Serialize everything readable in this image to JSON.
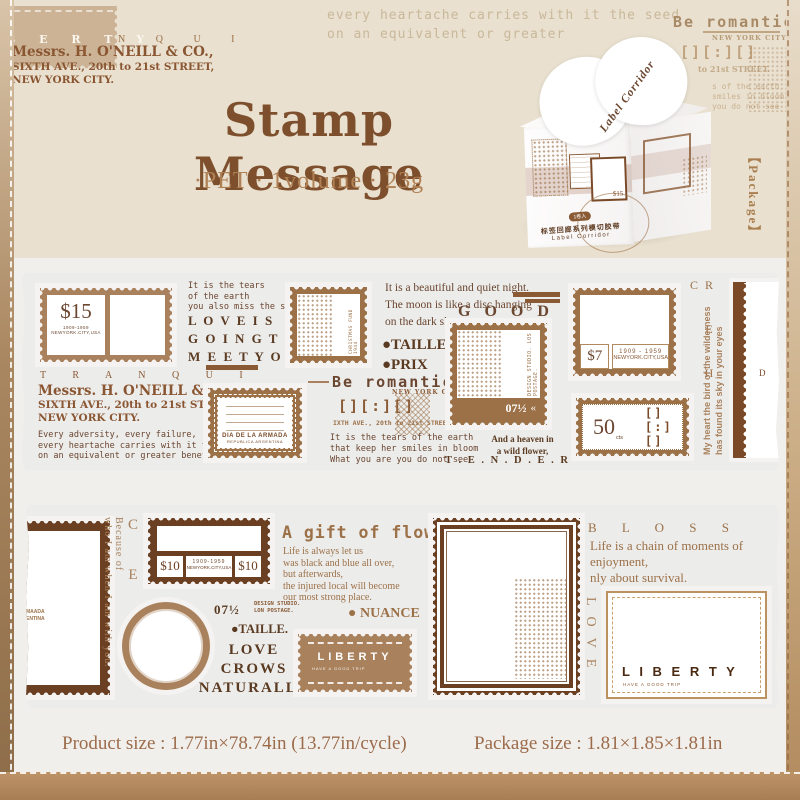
{
  "header": {
    "collage_white": "B E R T Y",
    "collage_brown": "N Q U I",
    "address1": "Messrs. H. O'NEILL & CO.,",
    "address2": "SIXTH AVE., 20th to 21st STREET,",
    "address3": "NEW YORK CITY.",
    "quote": "every heartache carries with it the seed\non an equivalent or greater",
    "be_romantic": "Be romantic",
    "be_city": "NEW YORK CITY.",
    "brackets": "[][:][]",
    "frag_street": "to 21st STREET.",
    "frag_lines": "s of the earth\nsmiles in bloom\nyou do not see",
    "title": "Stamp Message",
    "subtitle": "·PET · 1volume · 23g",
    "package": "【Package】"
  },
  "box": {
    "flap": "Label Corridor",
    "badge": "1卷入",
    "cn": "标签回廊系列模切胶带",
    "en": "Label Corridor",
    "stamp_value": "$15"
  },
  "strip1": {
    "stamp15_value": "$15",
    "stamp15_years": "1909-1959",
    "stamp15_city": "NEWYORK.CITY,USA",
    "tears": "It is the tears\nof the earth\nyou also miss the stars",
    "love": "L O V E   I S\nG O I N G   T O\nM E E T   Y O U",
    "tranqui": "T R A N Q U I",
    "address1": "Messrs. H. O'NEILL & CO.,",
    "address2": "SIXTH AVE., 20th to 21st STREET,",
    "address3": "NEW YORK CITY.",
    "adversity": "Every adversity, every failure,\nevery heartache carries with it the seed\non an equivalent or greater benefit.",
    "armada_title": "DIA DE LA ARMADA",
    "armada_sub": "REPUBLICA ARGENTINA",
    "christmas": "CHRISTMAS FUND 1944",
    "night": "It is a beautiful and quiet night.\nThe moon is like a disc hanging\non the dark sky ,",
    "good": "G O O D",
    "taille": "●TAILLE.",
    "prix": "●PRIX",
    "be_romantic": "Be romantic",
    "be_city": "NEW YORK CITY.",
    "brackets": "[][:][]",
    "street": "IXTH AVE., 20th to 21st STREET.",
    "tears2": "It is the tears of the earth\nthat keep her smiles in bloom\nWhat you are you do not see",
    "design_vertical": "DESIGN STUDIO. LOS POSTAGE.",
    "design_value": "07½",
    "design_chevrons": "«",
    "heaven": "And a heaven in\na wild flower,",
    "tender": "T . E . N . D . E . R",
    "cheer": "R E H C",
    "stamp7_value": "$7",
    "stamp7_years": "1909 - 1959",
    "stamp7_city": "NEWYORK.CITY,USA",
    "wilderness": "My heart the bird of the wilderness\nhas found its sky in your eyes",
    "cts_value": "50",
    "cts_unit": "cts",
    "cts_brackets": "[][:][]",
    "partial_letter": "D"
  },
  "strip2": {
    "partial_text": "MAADA\nENTINA",
    "nice": "N I C E",
    "because": "Because of\nwho I am when I am with you.",
    "stamp10_left": "$10",
    "stamp10_years": "1909-1959",
    "stamp10_city": "NEWYORK.CITY,USA",
    "stamp10_right": "$10",
    "ratio": "07½",
    "design_studio": "DESIGN STUDIO.\nLON POSTAGE.",
    "taille": "●TAILLE.",
    "love_crows": "LOVE\nCROWS\nNATURALLY",
    "gift_title": "A gift of flowers",
    "gift_text": "Life is always let us\nwas black and blue all over,\nbut afterwards,\nthe injured local will become\nour most strong place.",
    "nuance": "● NUANCE",
    "liberty_title": "LIBERTY",
    "liberty_sub": "HAVE A GOOD TRIP",
    "bloss": "B L O S S",
    "bloss_text": "Life is a chain of moments of\nenjoyment,\nnly about survival.",
    "love": "LOVE",
    "liberty2_title": "L I B E R T Y",
    "liberty2_sub": "HAVE A GOOD TRIP"
  },
  "footer": {
    "product_size": "Product size : 1.77in×78.74in (13.77in/cycle)",
    "package_size": "Package size : 1.81×1.85×1.81in"
  },
  "colors": {
    "dark_brown": "#6b3f22",
    "brown": "#8a5a35",
    "mid_brown": "#a9825d",
    "band_tan": "#b68c61",
    "backing_gray": "#ececeb",
    "page_beige": "#e9e0cf"
  }
}
